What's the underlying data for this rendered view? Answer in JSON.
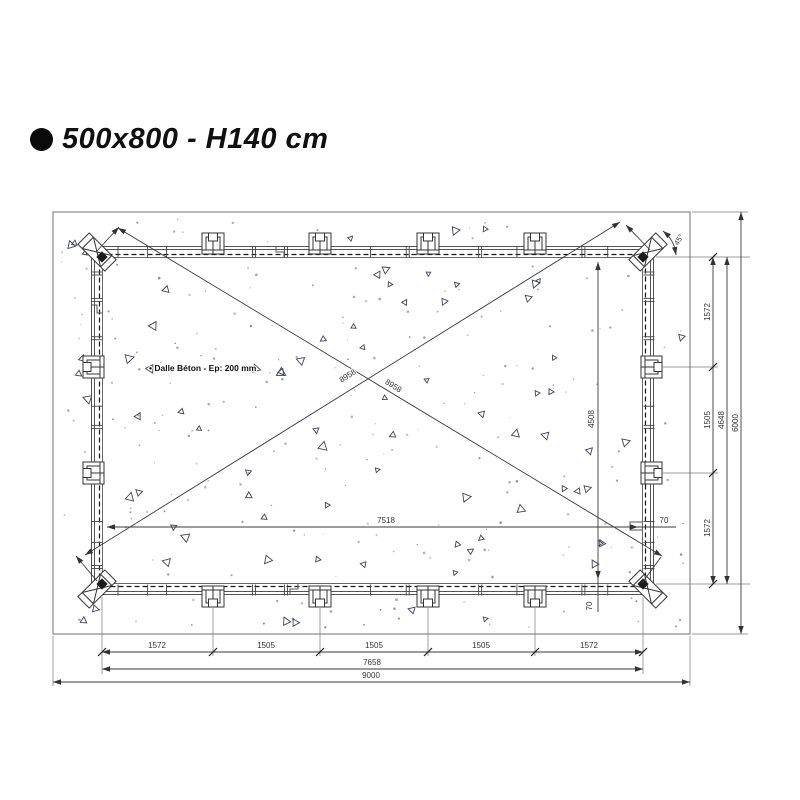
{
  "title": {
    "text": "500x800 - H140 cm"
  },
  "drawing": {
    "note": "• Dalle Béton - Ep: 200 mm",
    "diagonal_1": "8958",
    "diagonal_2": "8958",
    "corner_angle": "45°",
    "interior": {
      "width": "7518",
      "width_edge_offset": "70",
      "height": "4508",
      "height_edge_offset": "70"
    },
    "dims_bottom": {
      "chain": [
        "1572",
        "1505",
        "1505",
        "1505",
        "1572"
      ],
      "subtotal": "7658",
      "total": "9000"
    },
    "dims_right": {
      "chain": [
        "1572",
        "1505",
        "1572"
      ],
      "subtotal": "4648",
      "total": "6000"
    }
  },
  "colors": {
    "dimension_line": "#3a3a3a",
    "concrete_border": "#999999",
    "triangle_mark": "#41415c",
    "speckle": "#8d8d8d",
    "text": "#333333",
    "title": "#101010"
  }
}
